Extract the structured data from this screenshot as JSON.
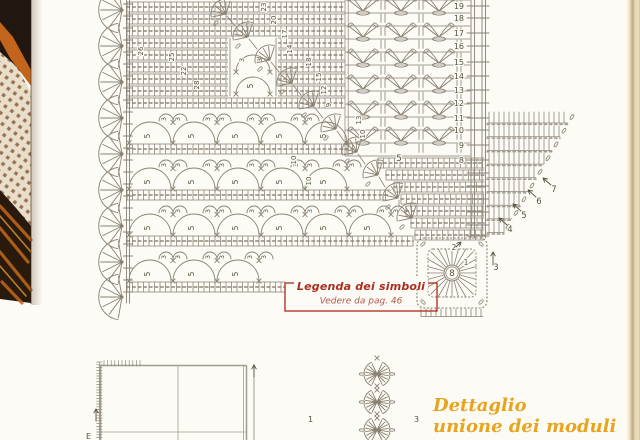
{
  "page": {
    "bg": "#fcfbf5"
  },
  "photo": {
    "black": "#221710",
    "orange": "#c2641c",
    "doily_bg": "#e9dec9",
    "hole_color": "#8a5e3c",
    "wood_dark": "#2a1a0e",
    "wood_orange": "#bf6a1a",
    "wood_light": "#dc9a30"
  },
  "chart": {
    "stroke_color": "#8a8173",
    "number_color": "#57523f",
    "center_label": "8",
    "arc_small_label": "3",
    "arc_big_label": "5",
    "right_row_numbers": [
      [
        "19",
        6
      ],
      [
        "18",
        18
      ],
      [
        "17",
        33
      ],
      [
        "16",
        46
      ],
      [
        "15",
        62
      ],
      [
        "14",
        76
      ],
      [
        "13",
        90
      ],
      [
        "12",
        103
      ],
      [
        "11",
        118
      ],
      [
        "10",
        130
      ],
      [
        "9",
        145
      ],
      [
        "8",
        160
      ]
    ],
    "corner_labels": [
      [
        "3",
        496,
        270
      ],
      [
        "4",
        510,
        232
      ],
      [
        "5",
        524,
        218
      ],
      [
        "6",
        539,
        204
      ],
      [
        "7",
        554,
        192
      ]
    ],
    "round_labels": [
      [
        "1",
        466,
        265
      ],
      [
        "2",
        454,
        250
      ]
    ],
    "interior_numbers": [
      [
        "26",
        143,
        51
      ],
      [
        "25",
        174,
        57
      ],
      [
        "22",
        186,
        71
      ],
      [
        "28",
        199,
        85
      ],
      [
        "23",
        266,
        7
      ],
      [
        "20",
        276,
        20
      ],
      [
        "17",
        287,
        34
      ],
      [
        "14",
        292,
        49
      ],
      [
        "18",
        311,
        62
      ],
      [
        "15",
        321,
        77
      ],
      [
        "12",
        326,
        90
      ],
      [
        "9",
        331,
        105
      ],
      [
        "13",
        361,
        120
      ],
      [
        "10",
        365,
        134
      ],
      [
        "10",
        296,
        160
      ],
      [
        "10",
        311,
        181
      ]
    ],
    "misc_labels": [
      [
        "5",
        399,
        161
      ]
    ]
  },
  "legend": {
    "title": "Legenda dei simboli",
    "subtitle": "Vedere da pag. 46",
    "border_color": "#b4372a",
    "title_color": "#ab2d1f",
    "subtitle_color": "#b05a50"
  },
  "bottom": {
    "caption_line1": "Dettaglio",
    "caption_line2": "unione dei moduli",
    "caption_color": "#e9a41f",
    "label_module1": "1",
    "label_module3": "3",
    "label_e": "E",
    "grid_stroke": "#a29c90"
  },
  "diagram": {
    "fans": {
      "px": 122,
      "r": 23,
      "ys": [
        10,
        46,
        82,
        118,
        154,
        190,
        226,
        262,
        297
      ]
    },
    "dense_rows": [
      [
        127,
        2,
        218
      ],
      [
        127,
        14,
        218
      ],
      [
        127,
        26,
        218
      ],
      [
        127,
        38,
        218
      ],
      [
        127,
        50,
        218
      ],
      [
        127,
        62,
        218
      ],
      [
        127,
        74,
        218
      ],
      [
        127,
        86,
        218
      ],
      [
        127,
        98,
        218
      ],
      [
        127,
        144,
        226
      ],
      [
        127,
        190,
        263
      ],
      [
        127,
        236,
        286
      ],
      [
        127,
        282,
        158
      ],
      [
        378,
        158,
        106
      ],
      [
        386,
        170,
        98
      ],
      [
        394,
        182,
        90
      ],
      [
        401,
        194,
        83
      ],
      [
        406,
        206,
        78
      ],
      [
        411,
        218,
        73
      ],
      [
        415,
        230,
        69
      ]
    ],
    "arc_bands": [
      {
        "y": 110,
        "cols": [
          150,
          194,
          238,
          282,
          326
        ],
        "end": 345
      },
      {
        "y": 156,
        "cols": [
          150,
          194,
          238,
          282,
          326
        ],
        "end": 352
      },
      {
        "y": 202,
        "cols": [
          150,
          194,
          238,
          282,
          326,
          370
        ],
        "end": 392
      },
      {
        "y": 248,
        "cols": [
          150,
          194,
          238
        ],
        "end": 300
      }
    ],
    "staircase": [
      [
        226,
        14
      ],
      [
        248,
        37
      ],
      [
        270,
        60
      ],
      [
        292,
        83
      ],
      [
        314,
        106
      ],
      [
        336,
        129
      ],
      [
        357,
        152
      ],
      [
        378,
        175
      ],
      [
        398,
        198
      ],
      [
        412,
        218
      ]
    ],
    "v_region": {
      "cols": [
        363,
        401,
        439
      ],
      "vrow_ys": [
        7,
        33,
        59,
        85,
        111,
        137
      ],
      "tickcols": [
        381,
        385,
        419,
        423,
        457,
        461
      ]
    },
    "right_column": {
      "lines": [
        471,
        474.5,
        482,
        485.5
      ]
    },
    "gusset": {
      "x0": 487,
      "ytop": 123,
      "dy": 13.7,
      "rows": 9,
      "xr0": 568,
      "slope": 8
    },
    "motif": {
      "cx": 452,
      "cy": 273,
      "half": 35
    },
    "module_strip": {
      "cx": 377,
      "ys": [
        374,
        402,
        430
      ]
    }
  }
}
